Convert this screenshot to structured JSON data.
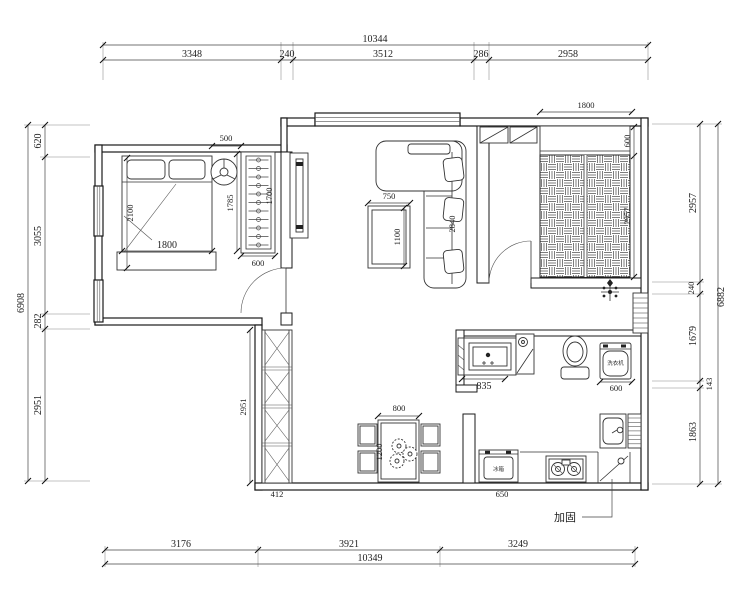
{
  "drawing": {
    "type": "apartment-floor-plan"
  },
  "dims": {
    "top": {
      "total": "10344",
      "s1": "3348",
      "s2": "240",
      "s3": "3512",
      "s4": "286",
      "s5": "2958"
    },
    "bottom": {
      "total": "10349",
      "s1": "3176",
      "s2": "3921",
      "s3": "3249"
    },
    "left": {
      "total": "6908",
      "s1": "620",
      "s2": "3055",
      "s3": "282",
      "s4": "2951"
    },
    "right": {
      "total": "6882",
      "s1": "2957",
      "s2": "240",
      "s3": "1679",
      "s4": "143",
      "s5": "1863"
    }
  },
  "rooms": {
    "bedroom1": {
      "niche": "500",
      "bed_width": "1800",
      "bed_length": "2100",
      "closet_length": "1785",
      "closet_inner": "1700",
      "closet_width": "600"
    },
    "living": {
      "table_width": "750",
      "table_length": "1100",
      "sofa_length": "2840"
    },
    "bedroom2": {
      "bed_width": "1800",
      "cabinet_depth": "600",
      "room_depth": "2957"
    },
    "bathroom": {
      "vanity_width": "835",
      "washer_width": "600",
      "washer_label": "洗衣机"
    },
    "dining": {
      "table_width": "800",
      "table_length": "1200"
    },
    "kitchen": {
      "fridge_width": "650",
      "fridge_label": "冰箱"
    },
    "hallway": {
      "cabinet_height": "2951",
      "cabinet_width": "412"
    }
  },
  "notes": {
    "reinforce": "加固"
  }
}
